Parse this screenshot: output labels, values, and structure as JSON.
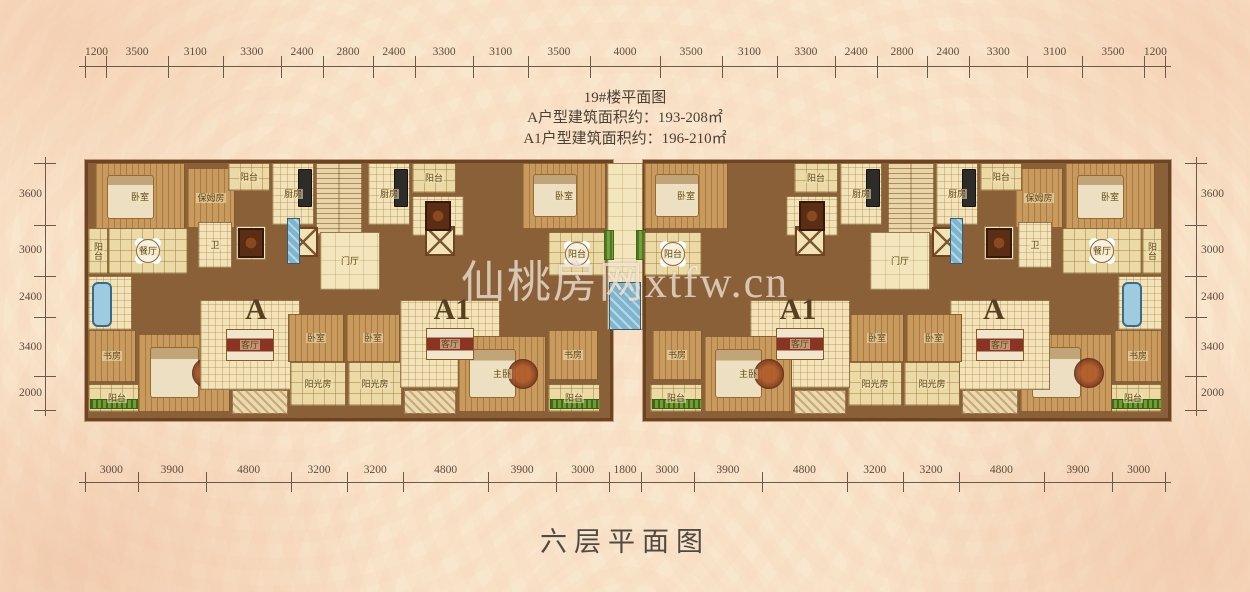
{
  "header": {
    "building_title": "19#楼平面图",
    "area_line_a": "A户型建筑面积约：193-208㎡",
    "area_line_a1": "A1户型建筑面积约：196-210㎡"
  },
  "footer": {
    "floor_title": "六层平面图"
  },
  "watermark": "仙桃房网xtfw.cn",
  "dimensions": {
    "top": [
      1200,
      3500,
      3100,
      3300,
      2400,
      2800,
      2400,
      3300,
      3100,
      3500,
      4000,
      3500,
      3100,
      3300,
      2400,
      2800,
      2400,
      3300,
      3100,
      3500,
      1200
    ],
    "bottom": [
      3000,
      3900,
      4800,
      3200,
      3200,
      4800,
      3900,
      3000,
      1800,
      3000,
      3900,
      4800,
      3200,
      3200,
      4800,
      3900,
      3000
    ],
    "left": [
      3600,
      3000,
      2400,
      3400,
      2000
    ],
    "right": [
      3600,
      3000,
      2400,
      3400,
      2000
    ]
  },
  "unit_labels": [
    {
      "text": "A",
      "x": 256,
      "y": 310
    },
    {
      "text": "A1",
      "x": 452,
      "y": 310
    },
    {
      "text": "A1",
      "x": 798,
      "y": 310
    },
    {
      "text": "A",
      "x": 994,
      "y": 310
    }
  ],
  "wings": [
    {
      "x": 85,
      "y": 160,
      "w": 522,
      "h": 255
    },
    {
      "x": 643,
      "y": 160,
      "w": 522,
      "h": 255
    }
  ],
  "rooms": [
    {
      "name": "bedroom",
      "x": 95,
      "y": 163,
      "w": 90,
      "h": 68,
      "t": "wood",
      "lbl": "卧室",
      "furn": [
        "bed"
      ]
    },
    {
      "name": "nanny-room",
      "x": 187,
      "y": 168,
      "w": 48,
      "h": 60,
      "t": "wood",
      "lbl": "保姆房"
    },
    {
      "name": "balcony",
      "x": 228,
      "y": 163,
      "w": 42,
      "h": 28,
      "t": "grid",
      "lbl": "阳台"
    },
    {
      "name": "kitchen",
      "x": 272,
      "y": 163,
      "w": 42,
      "h": 62,
      "t": "tile",
      "lbl": "厨房",
      "furn": [
        "stove"
      ]
    },
    {
      "name": "stair-core",
      "x": 316,
      "y": 163,
      "w": 46,
      "h": 72,
      "t": "stair"
    },
    {
      "name": "elevator",
      "x": 288,
      "y": 227,
      "w": 30,
      "h": 30,
      "t": "elev"
    },
    {
      "name": "foyer",
      "x": 320,
      "y": 232,
      "w": 60,
      "h": 58,
      "t": "plain",
      "lbl": "门厅"
    },
    {
      "name": "balcony",
      "x": 88,
      "y": 228,
      "w": 20,
      "h": 46,
      "t": "grid",
      "lbl": "阳台"
    },
    {
      "name": "dining-room",
      "x": 108,
      "y": 228,
      "w": 80,
      "h": 46,
      "t": "grid",
      "lbl": "餐厅",
      "furn": [
        "rtable"
      ]
    },
    {
      "name": "bathroom",
      "x": 88,
      "y": 276,
      "w": 44,
      "h": 54,
      "t": "tile",
      "furn": [
        "tub"
      ]
    },
    {
      "name": "bathroom",
      "x": 198,
      "y": 222,
      "w": 34,
      "h": 46,
      "t": "tile",
      "lbl": "卫"
    },
    {
      "name": "dining-nook",
      "x": 236,
      "y": 226,
      "w": 30,
      "h": 34,
      "t": "plain",
      "furn": [
        "dtable"
      ]
    },
    {
      "name": "study",
      "x": 88,
      "y": 330,
      "w": 48,
      "h": 52,
      "t": "wood",
      "lbl": "书房"
    },
    {
      "name": "balcony",
      "x": 88,
      "y": 384,
      "w": 58,
      "h": 28,
      "t": "grid",
      "lbl": "阳台",
      "furn": [
        "hedge"
      ]
    },
    {
      "name": "master-bedroom",
      "x": 138,
      "y": 334,
      "w": 92,
      "h": 78,
      "t": "wood",
      "furn": [
        "bed",
        "rug"
      ]
    },
    {
      "name": "living-room",
      "x": 200,
      "y": 300,
      "w": 100,
      "h": 90,
      "t": "tile",
      "lbl": "客厅",
      "furn": [
        "sofa"
      ]
    },
    {
      "name": "bedroom",
      "x": 288,
      "y": 314,
      "w": 56,
      "h": 48,
      "t": "wood",
      "lbl": "卧室"
    },
    {
      "name": "sunroom",
      "x": 290,
      "y": 362,
      "w": 56,
      "h": 44,
      "t": "grid",
      "lbl": "阳光房"
    },
    {
      "name": "sunroom",
      "x": 348,
      "y": 362,
      "w": 54,
      "h": 44,
      "t": "grid",
      "lbl": "阳光房"
    },
    {
      "name": "bedroom",
      "x": 346,
      "y": 314,
      "w": 54,
      "h": 48,
      "t": "wood",
      "lbl": "卧室"
    },
    {
      "name": "kitchen",
      "x": 368,
      "y": 163,
      "w": 42,
      "h": 62,
      "t": "tile",
      "lbl": "厨房",
      "furn": [
        "stove"
      ]
    },
    {
      "name": "balcony",
      "x": 412,
      "y": 163,
      "w": 44,
      "h": 30,
      "t": "grid",
      "lbl": "阳台"
    },
    {
      "name": "bathroom",
      "x": 412,
      "y": 196,
      "w": 52,
      "h": 40,
      "t": "tile",
      "furn": [
        "dtable"
      ]
    },
    {
      "name": "elevator",
      "x": 425,
      "y": 226,
      "w": 30,
      "h": 30,
      "t": "elev"
    },
    {
      "name": "living-room",
      "x": 400,
      "y": 300,
      "w": 100,
      "h": 88,
      "t": "tile",
      "lbl": "客厅",
      "furn": [
        "sofa"
      ]
    },
    {
      "name": "master-bedroom",
      "x": 458,
      "y": 336,
      "w": 88,
      "h": 76,
      "t": "wood",
      "lbl": "主卧",
      "furn": [
        "bed",
        "rug"
      ]
    },
    {
      "name": "study",
      "x": 548,
      "y": 330,
      "w": 50,
      "h": 50,
      "t": "wood",
      "lbl": "书房"
    },
    {
      "name": "balcony",
      "x": 548,
      "y": 384,
      "w": 52,
      "h": 28,
      "t": "grid",
      "lbl": "阳台",
      "furn": [
        "hedge"
      ]
    },
    {
      "name": "bedroom",
      "x": 522,
      "y": 163,
      "w": 84,
      "h": 66,
      "t": "wood",
      "lbl": "卧室",
      "furn": [
        "bed"
      ]
    },
    {
      "name": "balcony",
      "x": 548,
      "y": 232,
      "w": 58,
      "h": 44,
      "t": "grid",
      "lbl": "阳台",
      "furn": [
        "rtable"
      ]
    },
    {
      "name": "glass-window",
      "x": 287,
      "y": 218,
      "w": 13,
      "h": 46,
      "t": "glass"
    },
    {
      "name": "terrace-hatch",
      "x": 232,
      "y": 390,
      "w": 56,
      "h": 24,
      "t": "hatch"
    },
    {
      "name": "terrace-hatch",
      "x": 404,
      "y": 390,
      "w": 52,
      "h": 24,
      "t": "hatch"
    },
    {
      "name": "center-link",
      "x": 607,
      "y": 163,
      "w": 36,
      "h": 167,
      "t": "plain"
    },
    {
      "name": "planter",
      "x": 604,
      "y": 230,
      "w": 10,
      "h": 30,
      "t": "green"
    },
    {
      "name": "planter",
      "x": 636,
      "y": 230,
      "w": 10,
      "h": 30,
      "t": "green"
    },
    {
      "name": "glass-window",
      "x": 609,
      "y": 282,
      "w": 32,
      "h": 48,
      "t": "glass"
    },
    {
      "name": "bedroom",
      "x": 1065,
      "y": 163,
      "w": 90,
      "h": 68,
      "t": "wood",
      "lbl": "卧室",
      "furn": [
        "bed"
      ]
    },
    {
      "name": "nanny-room",
      "x": 1015,
      "y": 168,
      "w": 48,
      "h": 60,
      "t": "wood",
      "lbl": "保姆房"
    },
    {
      "name": "balcony",
      "x": 980,
      "y": 163,
      "w": 42,
      "h": 28,
      "t": "grid",
      "lbl": "阳台"
    },
    {
      "name": "kitchen",
      "x": 936,
      "y": 163,
      "w": 42,
      "h": 62,
      "t": "tile",
      "lbl": "厨房",
      "furn": [
        "stove"
      ]
    },
    {
      "name": "stair-core",
      "x": 888,
      "y": 163,
      "w": 46,
      "h": 72,
      "t": "stair"
    },
    {
      "name": "elevator",
      "x": 932,
      "y": 227,
      "w": 30,
      "h": 30,
      "t": "elev"
    },
    {
      "name": "foyer",
      "x": 870,
      "y": 232,
      "w": 60,
      "h": 58,
      "t": "plain",
      "lbl": "门厅"
    },
    {
      "name": "balcony",
      "x": 1142,
      "y": 228,
      "w": 20,
      "h": 46,
      "t": "grid",
      "lbl": "阳台"
    },
    {
      "name": "dining-room",
      "x": 1062,
      "y": 228,
      "w": 80,
      "h": 46,
      "t": "grid",
      "lbl": "餐厅",
      "furn": [
        "rtable"
      ]
    },
    {
      "name": "bathroom",
      "x": 1118,
      "y": 276,
      "w": 44,
      "h": 54,
      "t": "tile",
      "furn": [
        "tub"
      ]
    },
    {
      "name": "bathroom",
      "x": 1018,
      "y": 222,
      "w": 34,
      "h": 46,
      "t": "tile",
      "lbl": "卫"
    },
    {
      "name": "dining-nook",
      "x": 984,
      "y": 226,
      "w": 30,
      "h": 34,
      "t": "plain",
      "furn": [
        "dtable"
      ]
    },
    {
      "name": "study",
      "x": 1114,
      "y": 330,
      "w": 48,
      "h": 52,
      "t": "wood",
      "lbl": "书房"
    },
    {
      "name": "balcony",
      "x": 1104,
      "y": 384,
      "w": 58,
      "h": 28,
      "t": "grid",
      "lbl": "阳台",
      "furn": [
        "hedge"
      ]
    },
    {
      "name": "master-bedroom",
      "x": 1020,
      "y": 334,
      "w": 92,
      "h": 78,
      "t": "wood",
      "furn": [
        "bed",
        "rug"
      ]
    },
    {
      "name": "living-room",
      "x": 950,
      "y": 300,
      "w": 100,
      "h": 90,
      "t": "tile",
      "lbl": "客厅",
      "furn": [
        "sofa"
      ]
    },
    {
      "name": "bedroom",
      "x": 906,
      "y": 314,
      "w": 56,
      "h": 48,
      "t": "wood",
      "lbl": "卧室"
    },
    {
      "name": "sunroom",
      "x": 904,
      "y": 362,
      "w": 56,
      "h": 44,
      "t": "grid",
      "lbl": "阳光房"
    },
    {
      "name": "sunroom",
      "x": 848,
      "y": 362,
      "w": 54,
      "h": 44,
      "t": "grid",
      "lbl": "阳光房"
    },
    {
      "name": "bedroom",
      "x": 850,
      "y": 314,
      "w": 54,
      "h": 48,
      "t": "wood",
      "lbl": "卧室"
    },
    {
      "name": "kitchen",
      "x": 840,
      "y": 163,
      "w": 42,
      "h": 62,
      "t": "tile",
      "lbl": "厨房",
      "furn": [
        "stove"
      ]
    },
    {
      "name": "balcony",
      "x": 794,
      "y": 163,
      "w": 44,
      "h": 30,
      "t": "grid",
      "lbl": "阳台"
    },
    {
      "name": "bathroom",
      "x": 786,
      "y": 196,
      "w": 52,
      "h": 40,
      "t": "tile",
      "furn": [
        "dtable"
      ]
    },
    {
      "name": "elevator",
      "x": 795,
      "y": 226,
      "w": 30,
      "h": 30,
      "t": "elev"
    },
    {
      "name": "living-room",
      "x": 750,
      "y": 300,
      "w": 100,
      "h": 88,
      "t": "tile",
      "lbl": "客厅",
      "furn": [
        "sofa"
      ]
    },
    {
      "name": "master-bedroom",
      "x": 704,
      "y": 336,
      "w": 88,
      "h": 76,
      "t": "wood",
      "lbl": "主卧",
      "furn": [
        "bed",
        "rug"
      ]
    },
    {
      "name": "study",
      "x": 652,
      "y": 330,
      "w": 50,
      "h": 50,
      "t": "wood",
      "lbl": "书房"
    },
    {
      "name": "balcony",
      "x": 650,
      "y": 384,
      "w": 52,
      "h": 28,
      "t": "grid",
      "lbl": "阳台",
      "furn": [
        "hedge"
      ]
    },
    {
      "name": "bedroom",
      "x": 644,
      "y": 163,
      "w": 84,
      "h": 66,
      "t": "wood",
      "lbl": "卧室",
      "furn": [
        "bed"
      ]
    },
    {
      "name": "balcony",
      "x": 644,
      "y": 232,
      "w": 58,
      "h": 44,
      "t": "grid",
      "lbl": "阳台",
      "furn": [
        "rtable"
      ]
    },
    {
      "name": "glass-window",
      "x": 950,
      "y": 218,
      "w": 13,
      "h": 46,
      "t": "glass"
    },
    {
      "name": "terrace-hatch",
      "x": 962,
      "y": 390,
      "w": 56,
      "h": 24,
      "t": "hatch"
    },
    {
      "name": "terrace-hatch",
      "x": 794,
      "y": 390,
      "w": 52,
      "h": 24,
      "t": "hatch"
    }
  ],
  "palette": {
    "background": "#f9e7cd",
    "damask_pattern": "#f2c6a8",
    "wall_brown": "#6e431f",
    "floor_cream": "#f2e4b8",
    "wood_floor": "#c99a5e",
    "glass_blue": "#7fb6cf",
    "planter_green": "#74a238",
    "dim_text": "#5d4d3d",
    "title_text": "#4a3f33",
    "watermark_text": "#fffbf2"
  }
}
